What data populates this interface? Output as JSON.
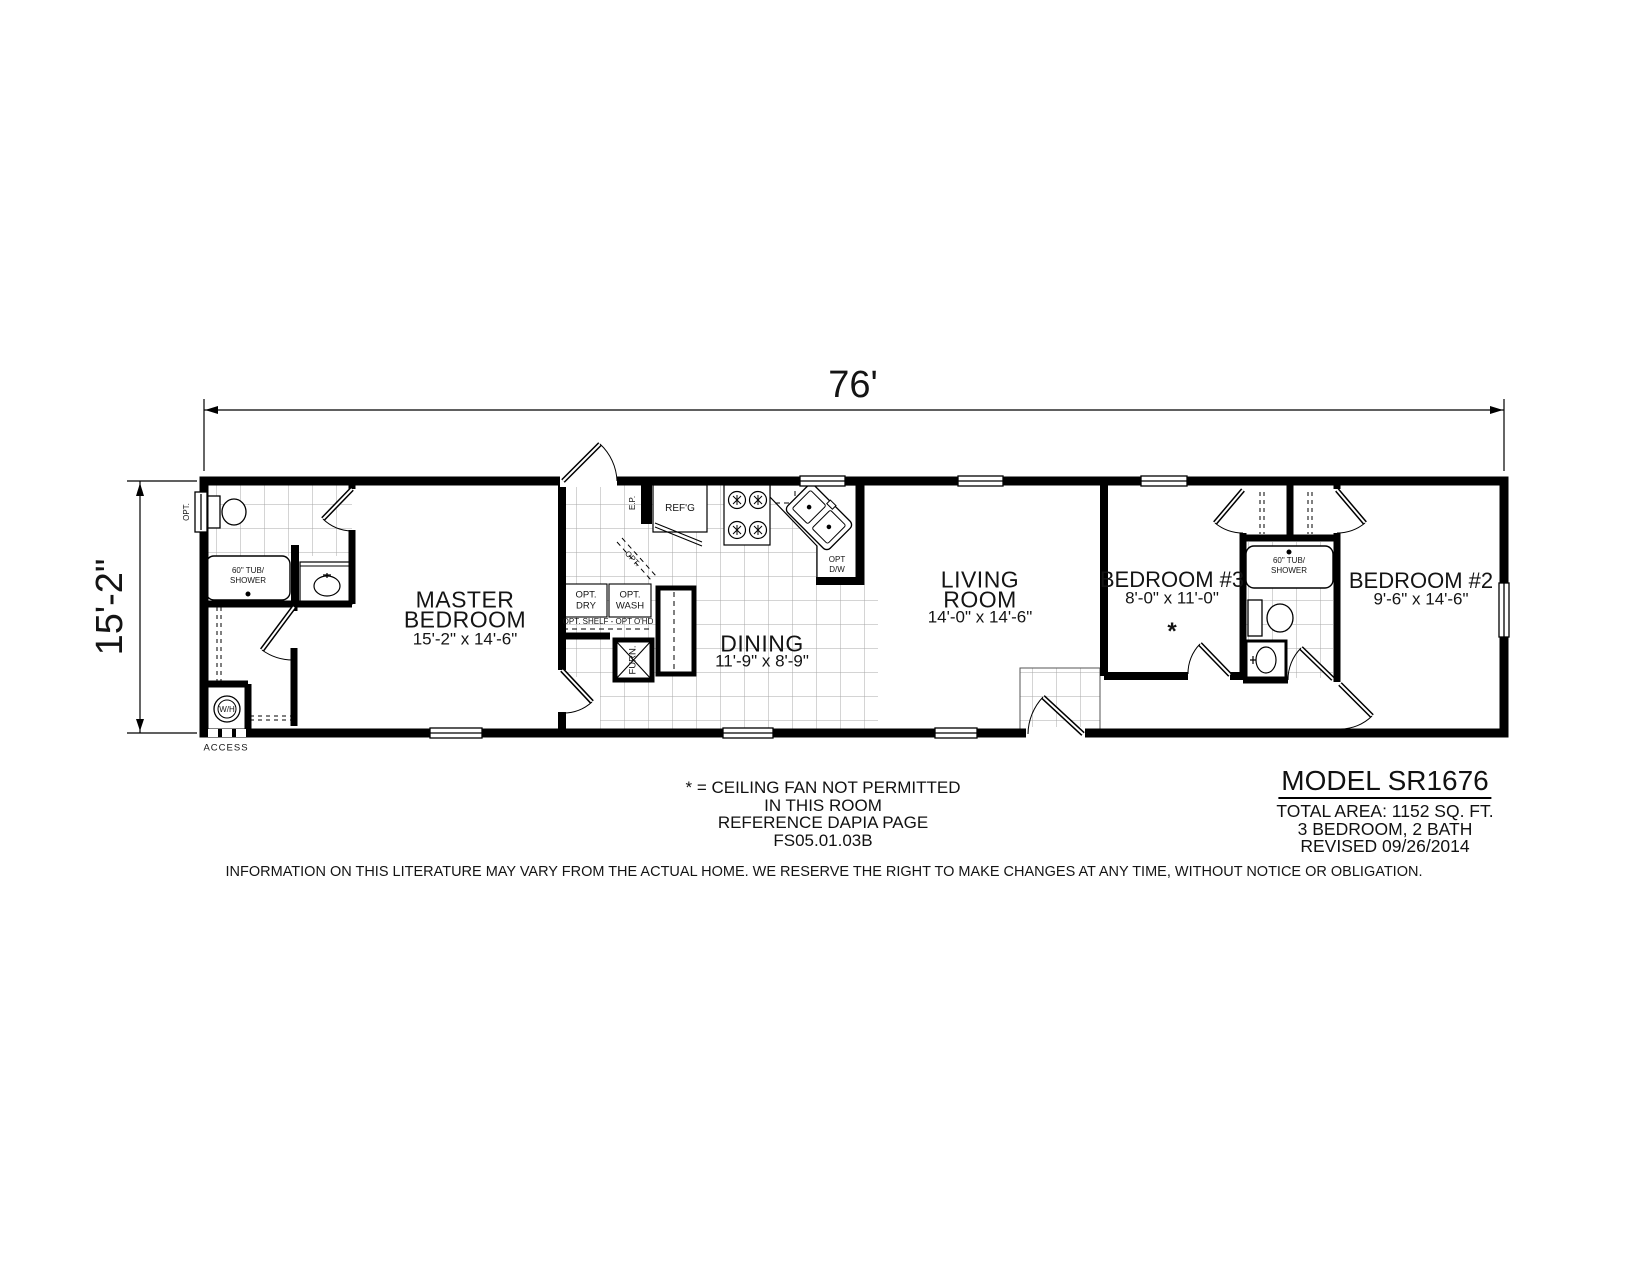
{
  "dimensions": {
    "width": "76'",
    "depth": "15'-2\""
  },
  "rooms": {
    "master_bedroom": {
      "line1": "MASTER",
      "line2": "BEDROOM",
      "size": "15'-2\" x 14'-6\""
    },
    "dining": {
      "name": "DINING",
      "size": "11'-9\" x 8'-9\""
    },
    "living_room": {
      "line1": "LIVING",
      "line2": "ROOM",
      "size": "14'-0\" x 14'-6\""
    },
    "bedroom3": {
      "name": "BEDROOM #3",
      "size": "8'-0\" x 11'-0\"",
      "marker": "*"
    },
    "bedroom2": {
      "name": "BEDROOM #2",
      "size": "9'-6\" x 14'-6\""
    }
  },
  "labels": {
    "master_tub_line1": "60\" TUB/",
    "master_tub_line2": "SHOWER",
    "bath2_tub_line1": "60\" TUB/",
    "bath2_tub_line2": "SHOWER",
    "water_heater": "W/H",
    "access": "ACCESS",
    "opt_window": "OPT.",
    "refrigerator": "REF'G",
    "electrical_panel": "E.P.",
    "opt_dishwasher_line1": "OPT",
    "opt_dishwasher_line2": "D/W",
    "opt_dryer_line1": "OPT.",
    "opt_dryer_line2": "DRY",
    "opt_washer_line1": "OPT.",
    "opt_washer_line2": "WASH",
    "opt_shelf": "OPT. SHELF - OPT O'HD",
    "furnace": "FURN.",
    "opt_pantry": "OPT."
  },
  "notes": {
    "line1": "* = CEILING FAN NOT PERMITTED",
    "line2": "IN THIS ROOM",
    "line3": "REFERENCE DAPIA PAGE",
    "line4": "FS05.01.03B"
  },
  "model_info": {
    "model": "MODEL SR1676",
    "total_area": "TOTAL AREA: 1152 SQ. FT.",
    "config": "3 BEDROOM, 2 BATH",
    "revised": "REVISED 09/26/2014"
  },
  "disclaimer": "INFORMATION ON THIS LITERATURE MAY VARY FROM THE ACTUAL HOME. WE RESERVE THE RIGHT TO MAKE CHANGES AT ANY TIME, WITHOUT NOTICE OR OBLIGATION.",
  "colors": {
    "wall": "#000000",
    "tile_grid": "#a8a8a8",
    "background": "#ffffff"
  }
}
